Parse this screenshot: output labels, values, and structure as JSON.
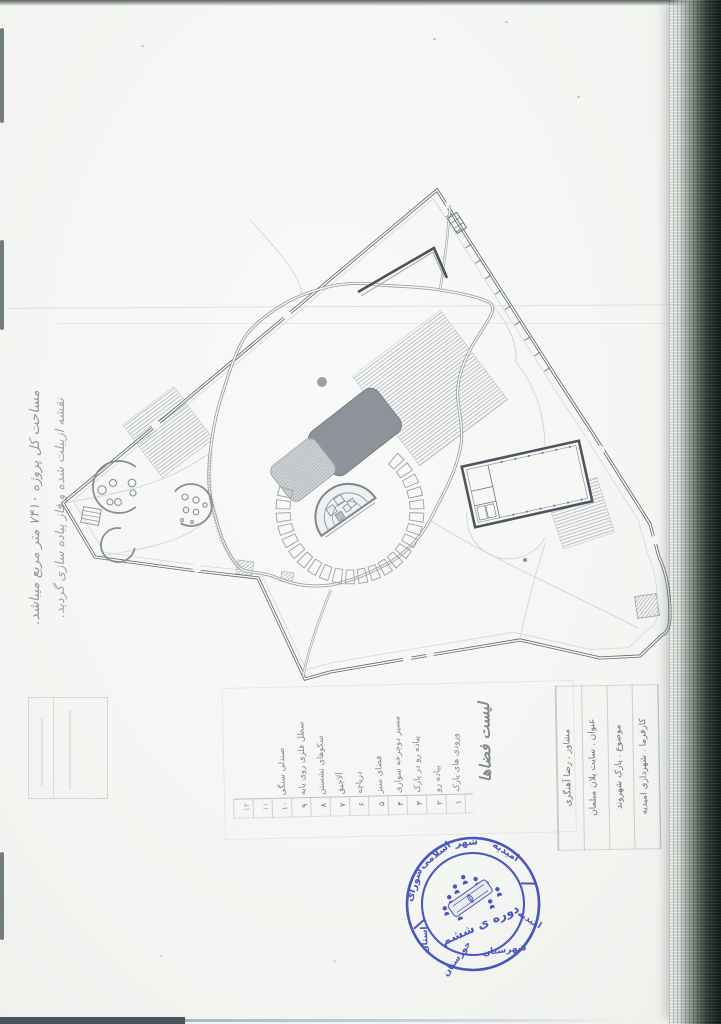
{
  "annotations": {
    "area_note": "مساحت کل پروژه ۷۴۱۰ متر مربع میباشد.",
    "asbuilt_note": "نقشه ازبیلت شده و فاز پیاده سازی گردید."
  },
  "legend": {
    "title": "لیست فضاها",
    "items": [
      {
        "no": "۱",
        "label": "ورودی های پارک"
      },
      {
        "no": "۲",
        "label": "پیاده رو"
      },
      {
        "no": "۳",
        "label": "پیاده رو در پارک"
      },
      {
        "no": "۴",
        "label": "مسیر دوچرخه سواری"
      },
      {
        "no": "۵",
        "label": "فضای سبز"
      },
      {
        "no": "۶",
        "label": "دریاچه"
      },
      {
        "no": "۷",
        "label": "آلاچیق"
      },
      {
        "no": "۸",
        "label": "سکوهای نشستن"
      },
      {
        "no": "۹",
        "label": "سطل فلزی روی پایه"
      },
      {
        "no": "۱۰",
        "label": "صندلی سنگی"
      },
      {
        "no": "۱۱",
        "label": ""
      },
      {
        "no": "۱۲",
        "label": ""
      }
    ]
  },
  "title_block": {
    "rows": [
      "کارفرما . شهرداری امیدیه",
      "موضوع . پارک شهروند",
      "عنوان . سایت پلان مبلمان",
      "مشاور . رضا آهنگری"
    ]
  },
  "stamp": {
    "color": "#3a48c4",
    "top_words": [
      "شورای",
      "اسلامی",
      "شهر",
      "امیدیه"
    ],
    "bottom_words": [
      "استان",
      "خوزستان",
      "شهرستان",
      "امیدیه"
    ],
    "center_text": "دوره ی ششم"
  }
}
